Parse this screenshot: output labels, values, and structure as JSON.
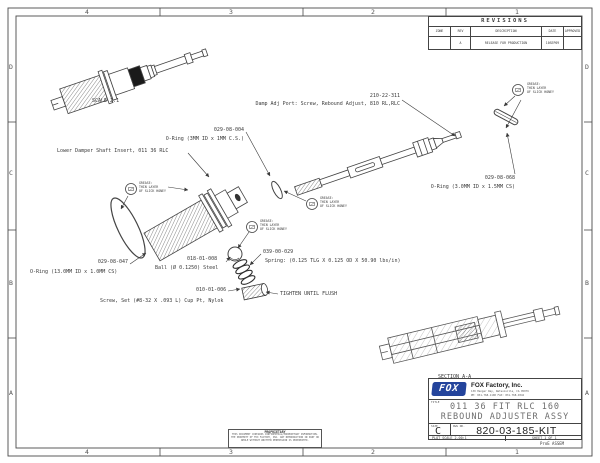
{
  "colors": {
    "logo_blue": "#24449c",
    "line_color": "#3a3a3a"
  },
  "border": {
    "top_zones": [
      "4",
      "3",
      "2",
      "1"
    ],
    "bottom_zones": [
      "4",
      "3",
      "2",
      "1"
    ],
    "left_zones": [
      "D",
      "C",
      "B",
      "A"
    ],
    "right_zones": [
      "D",
      "C",
      "B",
      "A"
    ]
  },
  "revisions": {
    "title": "REVISIONS",
    "headers": [
      "ZONE",
      "REV",
      "DESCRIPTION",
      "DATE",
      "APPROVED"
    ],
    "row": {
      "zone": "",
      "rev": "A",
      "description": "RELEASE FOR PRODUCTION",
      "date": "10SEP09",
      "approved": ""
    }
  },
  "views": {
    "scale_note": "SCALE  2:1",
    "section_label": "SECTION  A-A"
  },
  "callouts": {
    "damp_adj_part_no": "210-22-311",
    "damp_adj_desc": "Damp Adj Port: Screw, Rebound Adjust, 810 RL,RLC",
    "oring_3mm_part_no": "029-08-004",
    "oring_3mm_desc": "O-Ring (3MM ID x 1MM C.S.)",
    "shaft_insert_desc": "Lower Damper Shaft Insert, 011 36 RLC",
    "oring_13mm_part_no": "029-08-047",
    "oring_13mm_desc": "O-Ring (13.0MM ID x 1.0MM CS)",
    "ball_part_no": "018-01-008",
    "ball_desc": "Ball (Ø 0.1250) Steel",
    "spring_part_no": "039-00-029",
    "spring_desc": "Spring: (0.125 TLG X 0.125 OD X 50.90 lbs/in)",
    "set_screw_part_no": "010-01-006",
    "set_screw_desc": "Screw, Set (#8-32 X .093 L) Cup Pt, Nylok",
    "tighten_note": "TIGHTEN UNTIL FLUSH",
    "oring_3_0mm_part_no": "029-08-068",
    "oring_3_0mm_desc": "O-Ring (3.0MM ID x 1.5MM CS)",
    "grease_line1": "GREASE:",
    "grease_line2": "THIN LAYER",
    "grease_line3": "OF SLICK HONEY"
  },
  "title_block": {
    "logo_text": "FOX",
    "company": "FOX Factory, Inc.",
    "address1": "130 Hangar Way, Watsonville, CA 95076",
    "address2": "PH: 831-768-1100  FAX: 831-768-9342",
    "title_label": "TITLE",
    "title_line1": "011 36 FIT RLC 160",
    "title_line2": "REBOUND ADJUSTER ASSY",
    "size_label": "SIZE",
    "size_value": "C",
    "dwg_label": "DWG NO.",
    "dwg_number": "820-03-185-KIT",
    "plot_scale": "PLOT SCALE 2.00:1",
    "sheet": "SHEET 1 OF 1",
    "proe_note": "ProE ASSEM"
  },
  "proprietary": {
    "heading": "PROPRIETARY",
    "body": "THIS DOCUMENT CONTAINS CONFIDENTIAL/PROPRIETARY INFORMATION. THE PROPERTY OF FOX FACTORY, INC. ANY REPRODUCTION IN PART OR WHOLE WITHOUT WRITTEN PERMISSION IS PROHIBITED."
  }
}
